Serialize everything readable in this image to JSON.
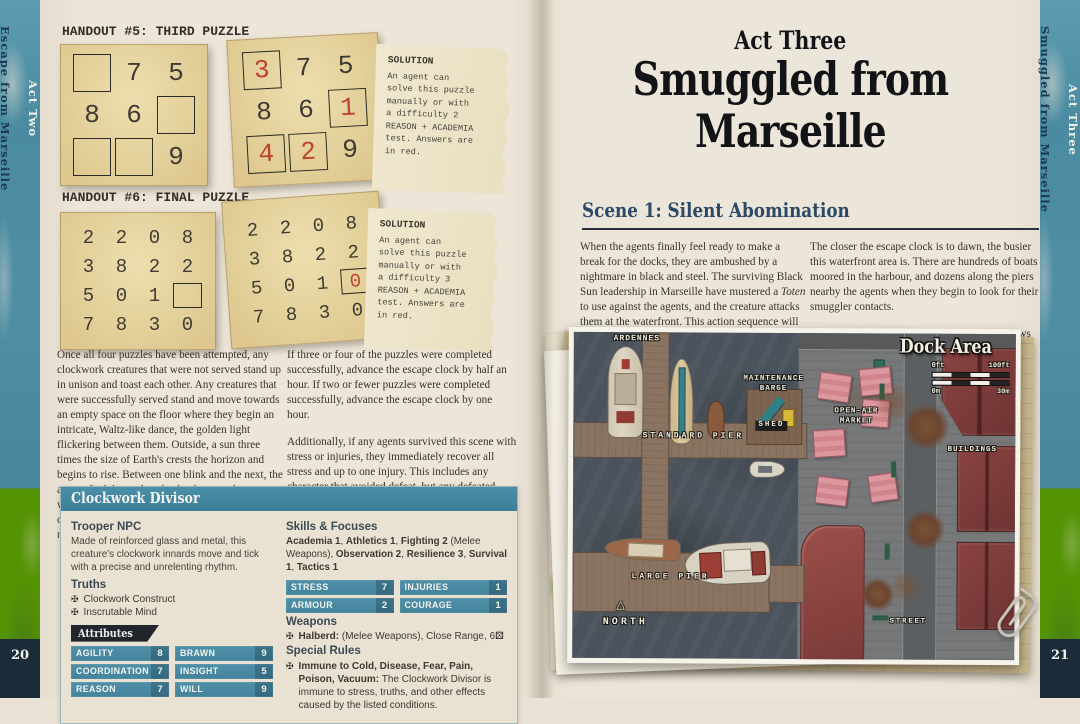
{
  "book": {
    "left_spine": {
      "act": "Act Two",
      "title": "Escape from Marseille",
      "page_number": "20"
    },
    "right_spine": {
      "act": "Act Three",
      "title": "Smuggled from Marseille",
      "page_number": "21"
    }
  },
  "left_page": {
    "handout5_heading": "HANDOUT #5: THIRD PUZZLE",
    "handout6_heading": "HANDOUT #6: FINAL PUZZLE",
    "puzzle5": {
      "rows": [
        [
          {
            "v": "",
            "b": 1
          },
          {
            "v": "7"
          },
          {
            "v": "5"
          }
        ],
        [
          {
            "v": "8"
          },
          {
            "v": "6"
          },
          {
            "v": "",
            "b": 1
          }
        ],
        [
          {
            "v": "",
            "b": 1
          },
          {
            "v": "",
            "b": 1
          },
          {
            "v": "9"
          }
        ]
      ],
      "solved_rows": [
        [
          {
            "v": "3",
            "b": 1,
            "r": 1
          },
          {
            "v": "7"
          },
          {
            "v": "5"
          }
        ],
        [
          {
            "v": "8"
          },
          {
            "v": "6"
          },
          {
            "v": "1",
            "b": 1,
            "r": 1
          }
        ],
        [
          {
            "v": "4",
            "b": 1,
            "r": 1
          },
          {
            "v": "2",
            "b": 1,
            "r": 1
          },
          {
            "v": "9"
          }
        ]
      ]
    },
    "puzzle6": {
      "rows": [
        [
          {
            "v": "2"
          },
          {
            "v": "2"
          },
          {
            "v": "0"
          },
          {
            "v": "8"
          }
        ],
        [
          {
            "v": "3"
          },
          {
            "v": "8"
          },
          {
            "v": "2"
          },
          {
            "v": "2"
          }
        ],
        [
          {
            "v": "5"
          },
          {
            "v": "0"
          },
          {
            "v": "1"
          },
          {
            "v": "",
            "b": 1
          }
        ],
        [
          {
            "v": "7"
          },
          {
            "v": "8"
          },
          {
            "v": "3"
          },
          {
            "v": "0"
          }
        ]
      ],
      "solved_rows": [
        [
          {
            "v": "2"
          },
          {
            "v": "2"
          },
          {
            "v": "0"
          },
          {
            "v": "8"
          }
        ],
        [
          {
            "v": "3"
          },
          {
            "v": "8"
          },
          {
            "v": "2"
          },
          {
            "v": "2"
          }
        ],
        [
          {
            "v": "5"
          },
          {
            "v": "0"
          },
          {
            "v": "1"
          },
          {
            "v": "0",
            "b": 1,
            "r": 1
          }
        ],
        [
          {
            "v": "7"
          },
          {
            "v": "8"
          },
          {
            "v": "3"
          },
          {
            "v": "0"
          }
        ]
      ]
    },
    "solution5": {
      "title": "SOLUTION",
      "text": "An agent can\nsolve this puzzle\nmanually or with\na difficulty 2\nREASON + ACADEMIA\ntest. Answers are\nin red."
    },
    "solution6": {
      "title": "SOLUTION",
      "text": "An agent can\nsolve this puzzle\nmanually or with\na difficulty 3\nREASON + ACADEMIA\ntest. Answers are\nin red."
    },
    "para_col1": "Once all four puzzles have been attempted, any clockwork creatures that were not served stand up in unison and toast each other. Any creatures that were successfully served stand and move towards an empty space on the floor where they begin an intricate, Waltz-like dance, the golden light flickering between them. Outside, a sun three times the size of Earth's crests the horizon and begins to rise. Between one blink and the next, the agents find themselves back wherever they were when the hallucination started. If any agents died or somehow stayed in that other place, they are nowhere to be found.",
    "para_col2a": "If three or four of the puzzles were completed successfully, advance the escape clock by half an hour. If two or fewer puzzles were completed successfully, advance the escape clock by one hour.",
    "para_col2b": "Additionally, if any agents survived this scene with stress or injuries, they immediately recover all stress and up to one injury. This includes any character that avoided defeat, but any defeated characters stay defeated. There is lasting stress for those who survived, but it is not as severe as it seemed.",
    "statblock": {
      "title": "Clockwork Divisor",
      "npc_type": "Trooper NPC",
      "description": "Made of reinforced glass and metal, this creature's clockwork innards move and tick with a precise and unrelenting rhythm.",
      "truths_label": "Truths",
      "truths": [
        "Clockwork Construct",
        "Inscrutable Mind"
      ],
      "attributes_label": "Attributes",
      "attributes": [
        {
          "label": "AGILITY",
          "value": "8"
        },
        {
          "label": "BRAWN",
          "value": "9"
        },
        {
          "label": "COORDINATION",
          "value": "7"
        },
        {
          "label": "INSIGHT",
          "value": "5"
        },
        {
          "label": "REASON",
          "value": "7"
        },
        {
          "label": "WILL",
          "value": "9"
        }
      ],
      "skills_label": "Skills & Focuses",
      "skills_segments": [
        {
          "t": "Academia 1",
          "b": 1
        },
        {
          "t": ", ",
          "b": 0
        },
        {
          "t": "Athletics 1",
          "b": 1
        },
        {
          "t": ", ",
          "b": 0
        },
        {
          "t": "Fighting 2",
          "b": 1
        },
        {
          "t": " (Melee Weapons), ",
          "b": 0
        },
        {
          "t": "Observation 2",
          "b": 1
        },
        {
          "t": ", ",
          "b": 0
        },
        {
          "t": "Resilience 3",
          "b": 1
        },
        {
          "t": ", ",
          "b": 0
        },
        {
          "t": "Survival 1",
          "b": 1
        },
        {
          "t": ", ",
          "b": 0
        },
        {
          "t": "Tactics 1",
          "b": 1
        }
      ],
      "stats": [
        {
          "label": "STRESS",
          "value": "7"
        },
        {
          "label": "INJURIES",
          "value": "1"
        },
        {
          "label": "ARMOUR",
          "value": "2"
        },
        {
          "label": "COURAGE",
          "value": "1"
        }
      ],
      "weapons_label": "Weapons",
      "weapon_segments": [
        {
          "t": "Halberd:",
          "b": 1
        },
        {
          "t": " (Melee Weapons), Close Range, 6",
          "b": 0
        }
      ],
      "special_label": "Special Rules",
      "special_segments": [
        {
          "t": "Immune to Cold, Disease, Fear, Pain, Poison, Vacuum:",
          "b": 1
        },
        {
          "t": " The Clockwork Divisor is immune to stress, truths, and other effects caused by the listed conditions.",
          "b": 0
        }
      ]
    }
  },
  "right_page": {
    "act_label": "Act Three",
    "title_line1": "Smuggled from",
    "title_line2": "Marseille",
    "scene_heading": "Scene 1: Silent Abomination",
    "col1_segments": [
      {
        "t": "When the agents finally feel ready to make a break for the docks, they are ambushed by a nightmare in black and steel. The surviving Black Sun leadership in Marseille have mustered a ",
        "b": 0
      },
      {
        "t": "Toten",
        "i": 1
      },
      {
        "t": " to use against the agents, and the creature attacks them at the waterfront. This action sequence will have been foreshadowed by the minor hallucination handout “The Lurker in the Dark.”",
        "b": 0
      }
    ],
    "col2_para1": "The closer the escape clock is to dawn, the busier this waterfront area is. There are hundreds of boats moored in the harbour, and dozens along the piers nearby the agents when they begin to look for their smuggler contacts.",
    "col2_para2_segments": [
      {
        "t": "Die Toten",
        "i": 1
      },
      {
        "t": ", silent except for the sound of its claws against stone, drops from the buildings opposite the waterfront",
        "b": 0
      }
    ],
    "map": {
      "title": "Dock Area",
      "scale": {
        "ft_min": "0ft",
        "ft_max": "100ft",
        "m_min": "0m",
        "m_max": "30m"
      },
      "north_arrow": "△",
      "labels": [
        {
          "t": "ARDENNES",
          "x": 20,
          "y": 2,
          "w": 86,
          "fs": 8
        },
        {
          "t": "MAINTENANCE\nBARGE",
          "x": 152,
          "y": 42,
          "w": 96,
          "fs": 7.5
        },
        {
          "t": "SHED",
          "x": 182,
          "y": 88,
          "fs": 7.5,
          "box": 1
        },
        {
          "t": "STANDARD PIER",
          "x": 50,
          "y": 99,
          "w": 140,
          "fs": 8,
          "ls": 3
        },
        {
          "t": "OPEN-AIR\nMARKET",
          "x": 246,
          "y": 74,
          "w": 74,
          "fs": 7.5
        },
        {
          "t": "BUILDINGS",
          "x": 356,
          "y": 112,
          "w": 86,
          "fs": 7.5
        },
        {
          "t": "LARGE PIER",
          "x": 46,
          "y": 240,
          "w": 104,
          "fs": 8,
          "ls": 3
        },
        {
          "t": "NORTH",
          "x": 16,
          "y": 284,
          "w": 74,
          "fs": 10,
          "ls": 3
        },
        {
          "t": "STREET",
          "x": 306,
          "y": 284,
          "w": 60,
          "fs": 7,
          "ls": 2
        }
      ]
    }
  },
  "colors": {
    "accent_teal": "#4186a0",
    "banner_dark": "#20262c",
    "answer_red": "#bf4030",
    "spine_teal": "#4a8ba1",
    "building_red": "#7c3a37"
  }
}
